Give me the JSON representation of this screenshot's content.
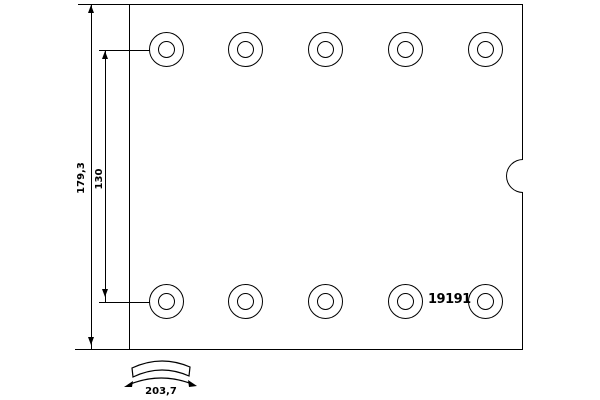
{
  "drawing": {
    "part_number": "19191",
    "dimensions": {
      "total_height": "179,3",
      "hole_row_spacing": "130",
      "arc_length": "203,7"
    },
    "holes": {
      "rows": 2,
      "per_row": 5,
      "total": 10
    },
    "colors": {
      "line": "#000000",
      "background": "#ffffff",
      "text": "#000000"
    },
    "icons": {
      "curvature_icon": "curved-band-with-double-arrow"
    }
  }
}
